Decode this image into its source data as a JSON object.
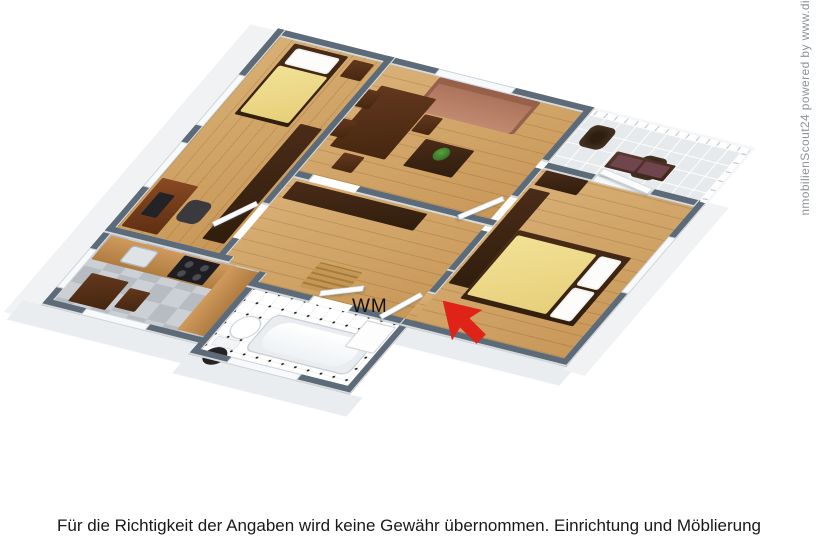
{
  "floorplan": {
    "wm_label": "WM",
    "colors": {
      "wall_top": "#5d6b79",
      "wall_face": "#f0f2f4",
      "wood_floor": "#cfa366",
      "kitchen_tile_light": "#ccd0d5",
      "kitchen_tile_dark": "#b7bcc3",
      "bath_tile_white": "#ffffff",
      "bath_tile_dot": "#1c1c1c",
      "bed_linen_yellow": "#eedc8c",
      "pillow_white": "#fcfcfa",
      "dark_wood_furniture": "#3a2214",
      "desk_wood": "#7d4220",
      "sofa_brown": "#b5806a",
      "plant_green": "#3e7a2c",
      "kitchen_counter_wood": "#c08a4f",
      "balcony_floor": "#e7eaec",
      "entrance_arrow_red": "#e02318"
    }
  },
  "watermark": {
    "text": "ImmobilienScout24 powered by www.di"
  },
  "disclaimer": {
    "text": "Für die Richtigkeit der Angaben wird keine Gewähr übernommen. Einrichtung und Möblierung"
  }
}
